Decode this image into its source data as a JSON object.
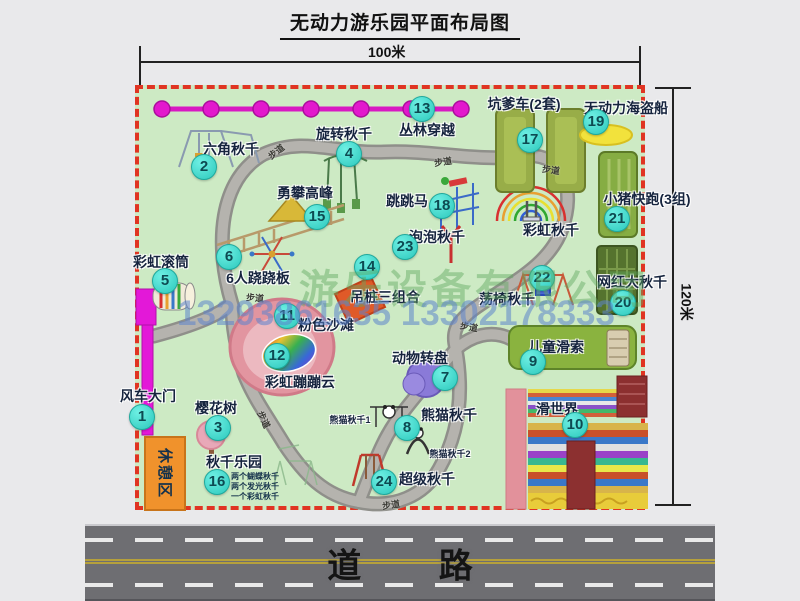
{
  "title": "无动力游乐园平面布局图",
  "dimensions": {
    "width": "100米",
    "height": "120米"
  },
  "road_label": "道 路",
  "path_label": "步道",
  "watermark": {
    "company": "游乐设备有限公司",
    "phone": "13293861635 13302178333"
  },
  "labels": {
    "rest_area": "休憩区",
    "rainbow_swing": "彩虹秋千",
    "panda_swing_1": "熊猫秋千1",
    "panda_swing_2": "熊猫秋千2"
  },
  "colors": {
    "map_green": "#cdeac4",
    "border_red": "#e03422",
    "badge_teal": "#3fe0d2",
    "gate_magenta": "#e318d8",
    "road_gray": "#6e6e72",
    "beach_pink": "#e295a0"
  },
  "attractions": [
    {
      "num": "1",
      "label": "风车大门"
    },
    {
      "num": "2",
      "label": "六角秋千"
    },
    {
      "num": "3",
      "label": "樱花树"
    },
    {
      "num": "4",
      "label": "旋转秋千"
    },
    {
      "num": "5",
      "label": "彩虹滚筒"
    },
    {
      "num": "6",
      "label": "6人跷跷板"
    },
    {
      "num": "7",
      "label": "动物转盘"
    },
    {
      "num": "8",
      "label": "熊猫秋千"
    },
    {
      "num": "9",
      "label": "儿童滑索"
    },
    {
      "num": "10",
      "label": "滑世界"
    },
    {
      "num": "11",
      "label": "粉色沙滩"
    },
    {
      "num": "12",
      "label": "彩虹蹦蹦云"
    },
    {
      "num": "13",
      "label": "丛林穿越"
    },
    {
      "num": "14",
      "label": "吊桩三组合"
    },
    {
      "num": "15",
      "label": "勇攀高峰"
    },
    {
      "num": "16",
      "label": "秋千乐园",
      "notes": [
        "两个蝴蝶秋千",
        "两个发光秋千",
        "一个彩虹秋千"
      ]
    },
    {
      "num": "17",
      "label": "坑爹车(2套)"
    },
    {
      "num": "18",
      "label": "跳跳马"
    },
    {
      "num": "19",
      "label": "无动力海盗船"
    },
    {
      "num": "20",
      "label": "网红大秋千"
    },
    {
      "num": "21",
      "label": "小猪快跑(3组)"
    },
    {
      "num": "22",
      "label": "荡椅秋千"
    },
    {
      "num": "23",
      "label": "泡泡秋千"
    },
    {
      "num": "24",
      "label": "超级秋千"
    }
  ]
}
